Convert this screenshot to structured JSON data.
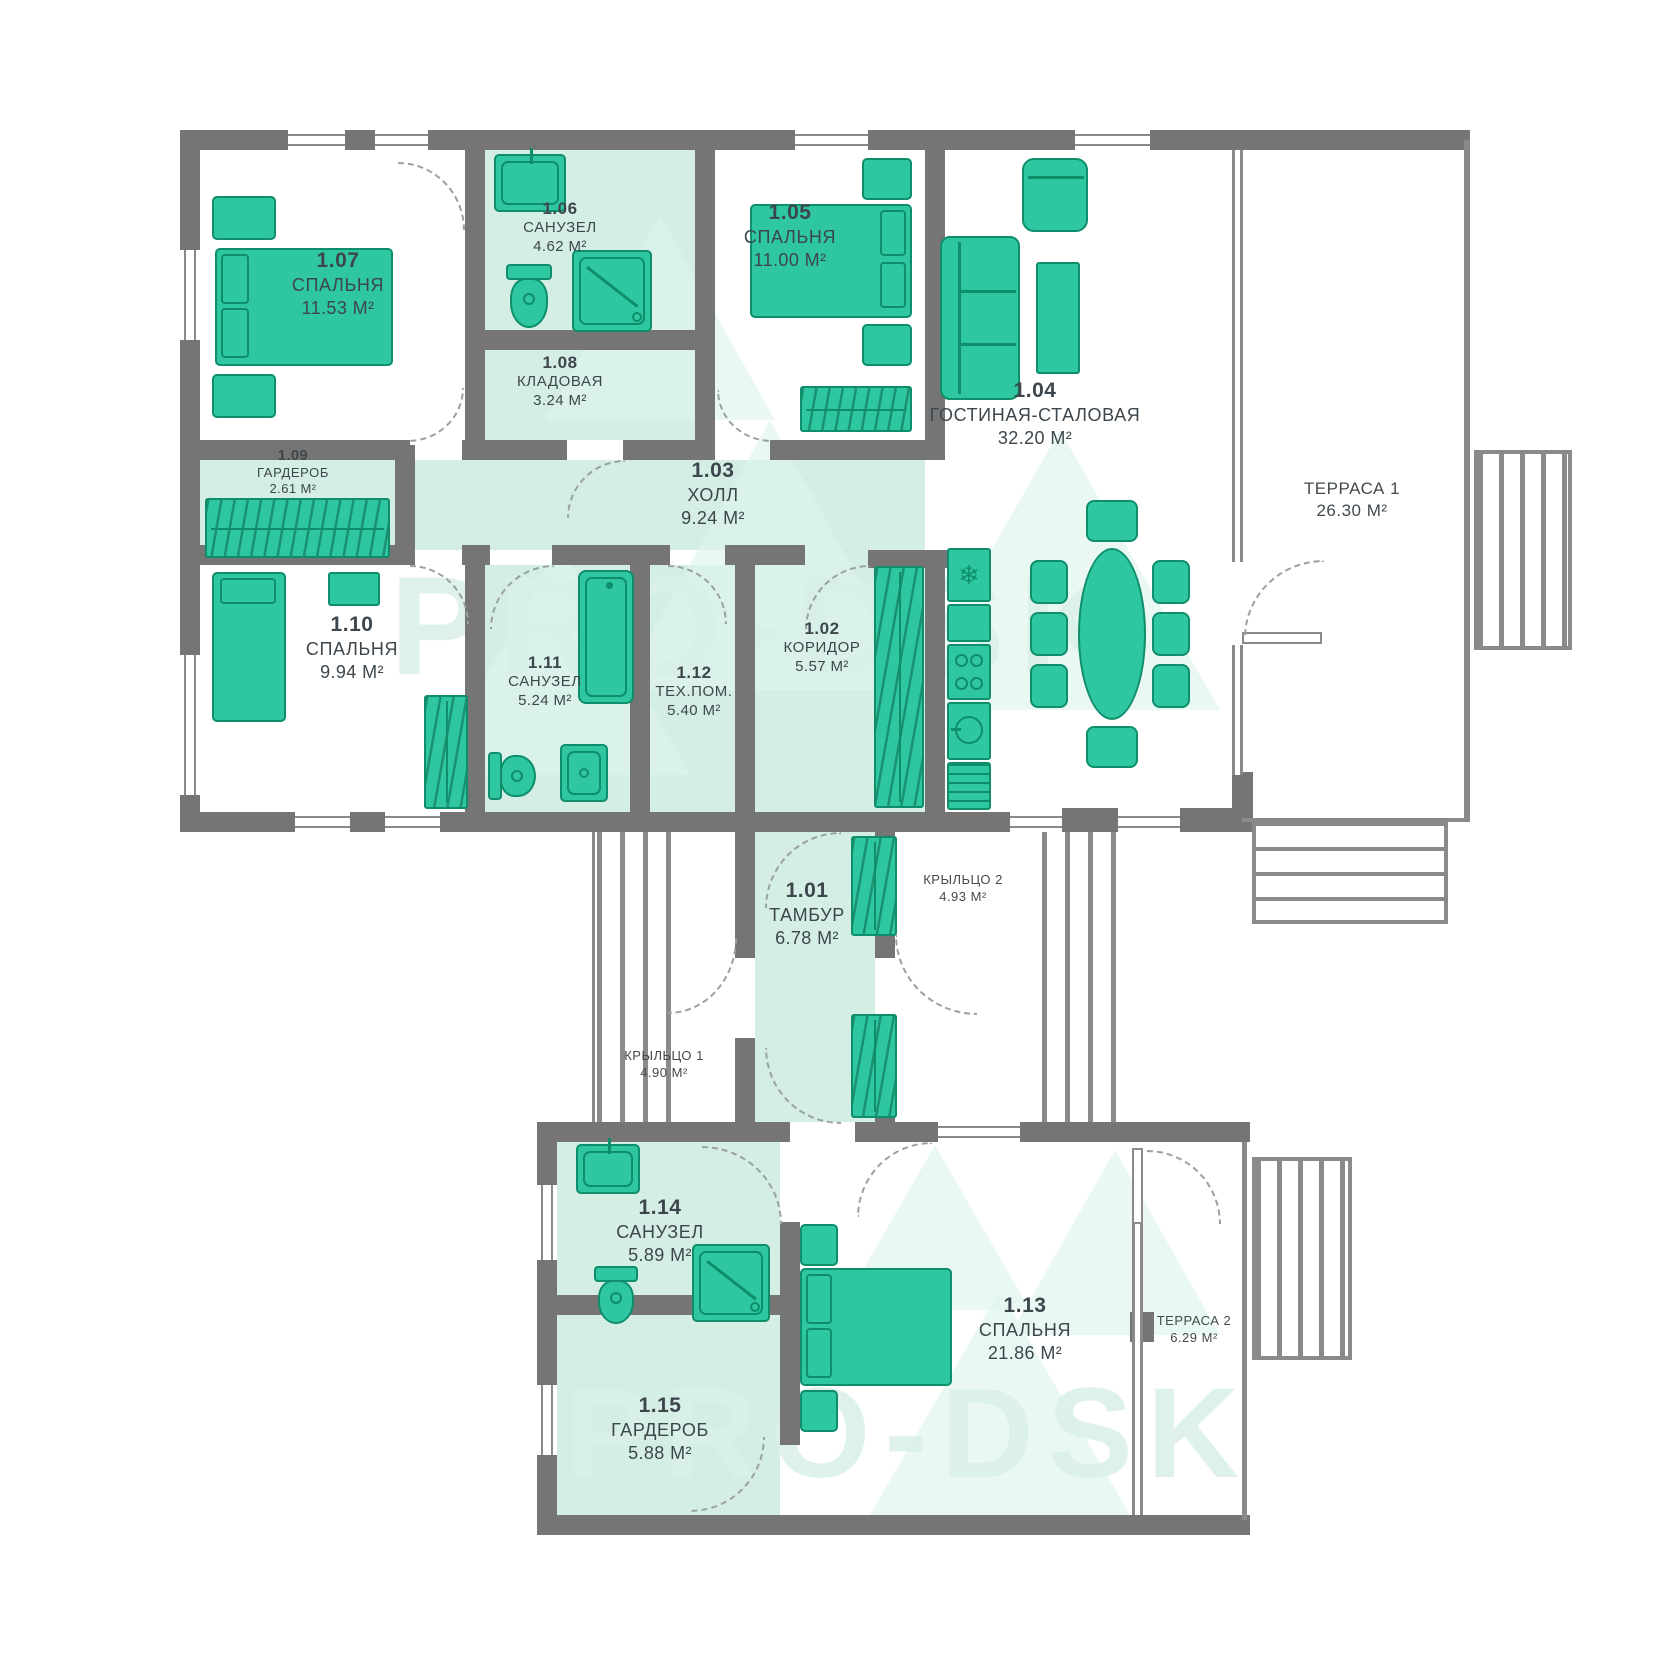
{
  "plan": {
    "watermark": "PRO-DSK",
    "area_unit": "М²",
    "colors": {
      "accent_green": "#2ec7a1",
      "accent_green_dark": "#0e8e6b",
      "wall_gray": "#757575",
      "room_tint": "#d5eee5",
      "label_text": "#3d464c"
    }
  },
  "rooms": [
    {
      "number": "1.01",
      "name": "ТАМБУР",
      "area": "6.78 М²"
    },
    {
      "number": "1.02",
      "name": "КОРИДОР",
      "area": "5.57 М²"
    },
    {
      "number": "1.03",
      "name": "ХОЛЛ",
      "area": "9.24 М²"
    },
    {
      "number": "1.04",
      "name": "ГОСТИНАЯ-СТАЛОВАЯ",
      "area": "32.20 М²"
    },
    {
      "number": "1.05",
      "name": "СПАЛЬНЯ",
      "area": "11.00 М²"
    },
    {
      "number": "1.06",
      "name": "САНУЗЕЛ",
      "area": "4.62 М²"
    },
    {
      "number": "1.07",
      "name": "СПАЛЬНЯ",
      "area": "11.53 М²"
    },
    {
      "number": "1.08",
      "name": "КЛАДОВАЯ",
      "area": "3.24 М²"
    },
    {
      "number": "1.09",
      "name": "ГАРДЕРОБ",
      "area": "2.61 М²"
    },
    {
      "number": "1.10",
      "name": "СПАЛЬНЯ",
      "area": "9.94 М²"
    },
    {
      "number": "1.11",
      "name": "САНУЗЕЛ",
      "area": "5.24 М²"
    },
    {
      "number": "1.12",
      "name": "ТЕХ.ПОМ.",
      "area": "5.40 М²"
    },
    {
      "number": "1.13",
      "name": "СПАЛЬНЯ",
      "area": "21.86 М²"
    },
    {
      "number": "1.14",
      "name": "САНУЗЕЛ",
      "area": "5.89 М²"
    },
    {
      "number": "1.15",
      "name": "ГАРДЕРОБ",
      "area": "5.88 М²"
    }
  ],
  "outdoor": [
    {
      "name": "ТЕРРАСА 1",
      "area": "26.30 М²"
    },
    {
      "name": "ТЕРРАСА 2",
      "area": "6.29 М²"
    },
    {
      "name": "КРЫЛЬЦО 1",
      "area": "4.90 М²"
    },
    {
      "name": "КРЫЛЬЦО 2",
      "area": "4.93 М²"
    }
  ]
}
